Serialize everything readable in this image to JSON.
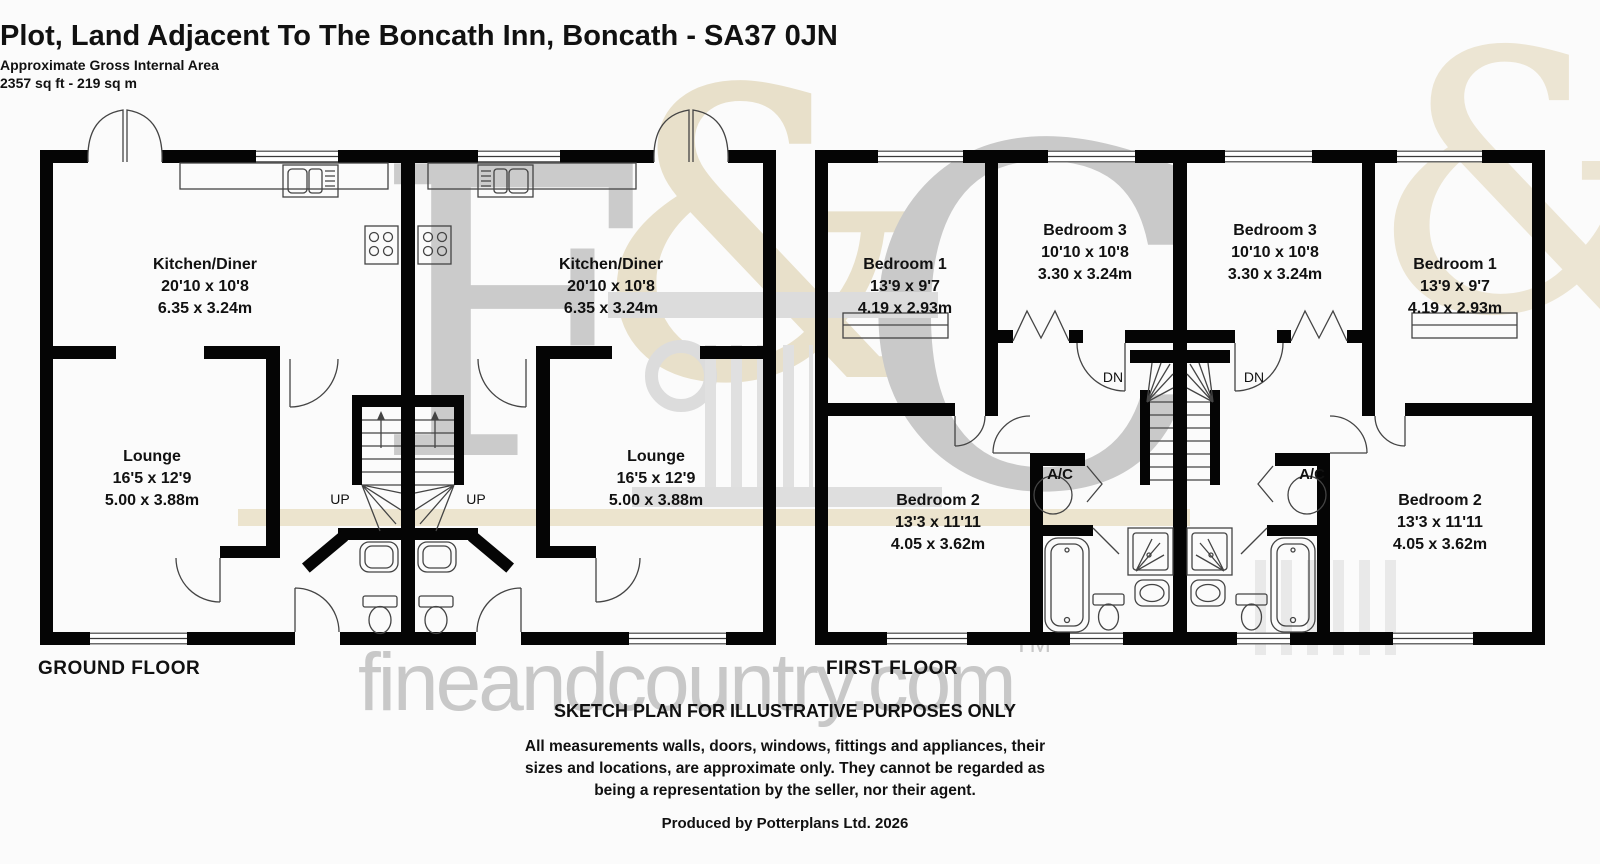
{
  "header": {
    "title": "Plot, Land Adjacent To The Boncath Inn, Boncath - SA37 0JN",
    "subtitle": "Approximate Gross Internal Area",
    "area": "2357 sq ft - 219 sq m"
  },
  "floors": {
    "ground_label": "GROUND FLOOR",
    "first_label": "FIRST FLOOR"
  },
  "rooms": {
    "kitchen_diner": {
      "name": "Kitchen/Diner",
      "imperial": "20'10 x 10'8",
      "metric": "6.35 x 3.24m"
    },
    "lounge": {
      "name": "Lounge",
      "imperial": "16'5 x 12'9",
      "metric": "5.00 x 3.88m"
    },
    "bedroom_1": {
      "name": "Bedroom 1",
      "imperial": "13'9 x 9'7",
      "metric": "4.19 x 2.93m"
    },
    "bedroom_2": {
      "name": "Bedroom 2",
      "imperial": "13'3 x 11'11",
      "metric": "4.05 x 3.62m"
    },
    "bedroom_3": {
      "name": "Bedroom 3",
      "imperial": "10'10 x 10'8",
      "metric": "3.30 x 3.24m"
    },
    "airing_cupboard": "A/C",
    "stairs_up": "UP",
    "stairs_down": "DN"
  },
  "footer": {
    "sketch_notice": "SKETCH PLAN FOR ILLUSTRATIVE PURPOSES ONLY",
    "disclaimer_line1": "All measurements walls, doors, windows, fittings and appliances, their",
    "disclaimer_line2": "sizes and locations, are approximate only. They cannot be regarded as",
    "disclaimer_line3": "being a representation by the seller, nor their agent.",
    "produced_by": "Produced by Potterplans Ltd. 2026"
  },
  "watermark": {
    "letter_f": "F",
    "ampersand": "&",
    "letter_c": "C",
    "site_name": "fineandcountry.com",
    "trademark": "TM"
  },
  "colors": {
    "wall": "#000000",
    "label_text": "#111111",
    "watermark_gray": "#c9c9c9",
    "watermark_beige": "#e8e0ca"
  }
}
